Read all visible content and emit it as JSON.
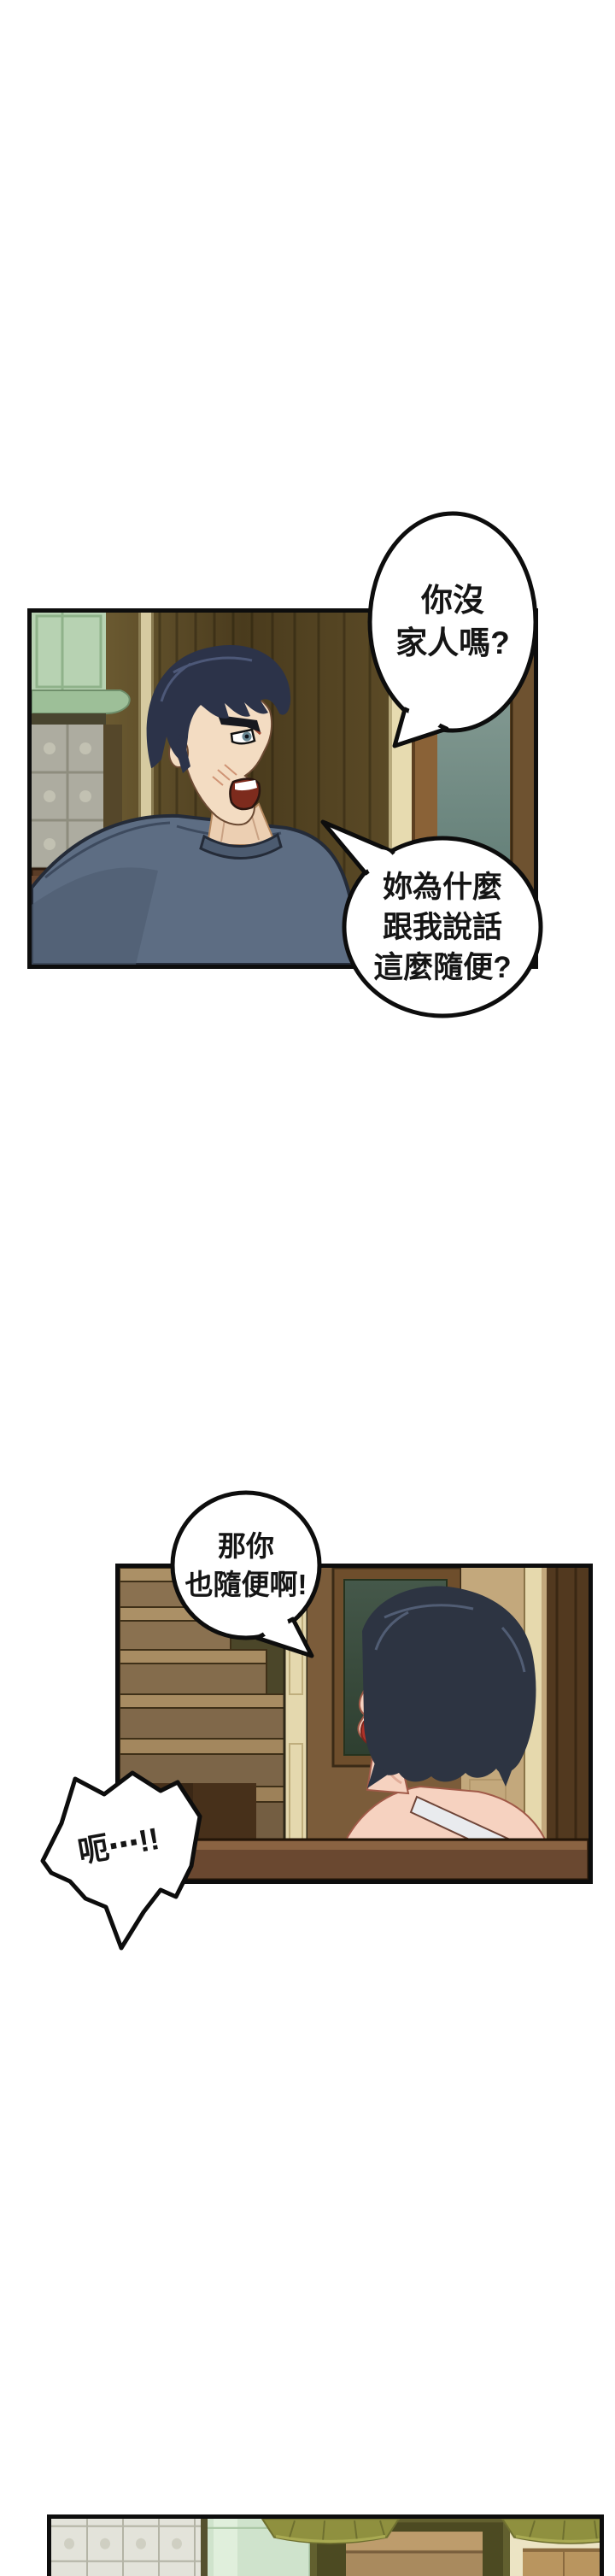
{
  "page": {
    "type": "webtoon-comic-page",
    "background": "#ffffff",
    "panel_count": 3
  },
  "bubbles": [
    {
      "name": "speech-bubble-1",
      "speaker": "man",
      "lines": [
        "你沒",
        "家人嗎?"
      ]
    },
    {
      "name": "speech-bubble-2",
      "speaker": "man",
      "lines": [
        "妳為什麼",
        "跟我說話",
        "這麼隨便?"
      ]
    },
    {
      "name": "speech-bubble-3",
      "speaker": "woman",
      "lines": [
        "那你",
        "也隨便啊!"
      ]
    },
    {
      "name": "burst-bubble",
      "speaker": "man",
      "lines": [
        "呃⋯!!"
      ]
    }
  ],
  "panels": [
    {
      "name": "panel-kitchen-man",
      "description": "Angry man with dark spiky hair in blue-gray t-shirt shouting; kitchen with mint cabinet, glass-block tiles, wood wall and door"
    },
    {
      "name": "panel-stairs-woman",
      "description": "Smiling woman with dark bob hair and white tank top strap beside wooden staircase and door"
    },
    {
      "name": "panel-room-cropped",
      "description": "Room bottom strip: glass-block wall, mint cabinet, olive wardrobe with drawers, hanging lamps (cropped by page edge)"
    }
  ],
  "colors": {
    "outline": "#0d0d0d",
    "man_shirt": "#5d6d83",
    "man_hair": "#2c3349",
    "man_skin": "#f3dcc2",
    "mouth_interior": "#7d2b1d",
    "wood_wall": "#63522c",
    "mint_cabinet": "#b7d2b2",
    "tile": "#adaca0",
    "door_glass": "#7e948e",
    "stairs": "#a88d60",
    "woman_hair": "#2d3442",
    "woman_skin": "#f6d2c0",
    "woman_lips": "#b03228",
    "chair_wood": "#6a4830",
    "lamp_shade": "#8f903f",
    "wall_tan": "#c3a87c"
  }
}
